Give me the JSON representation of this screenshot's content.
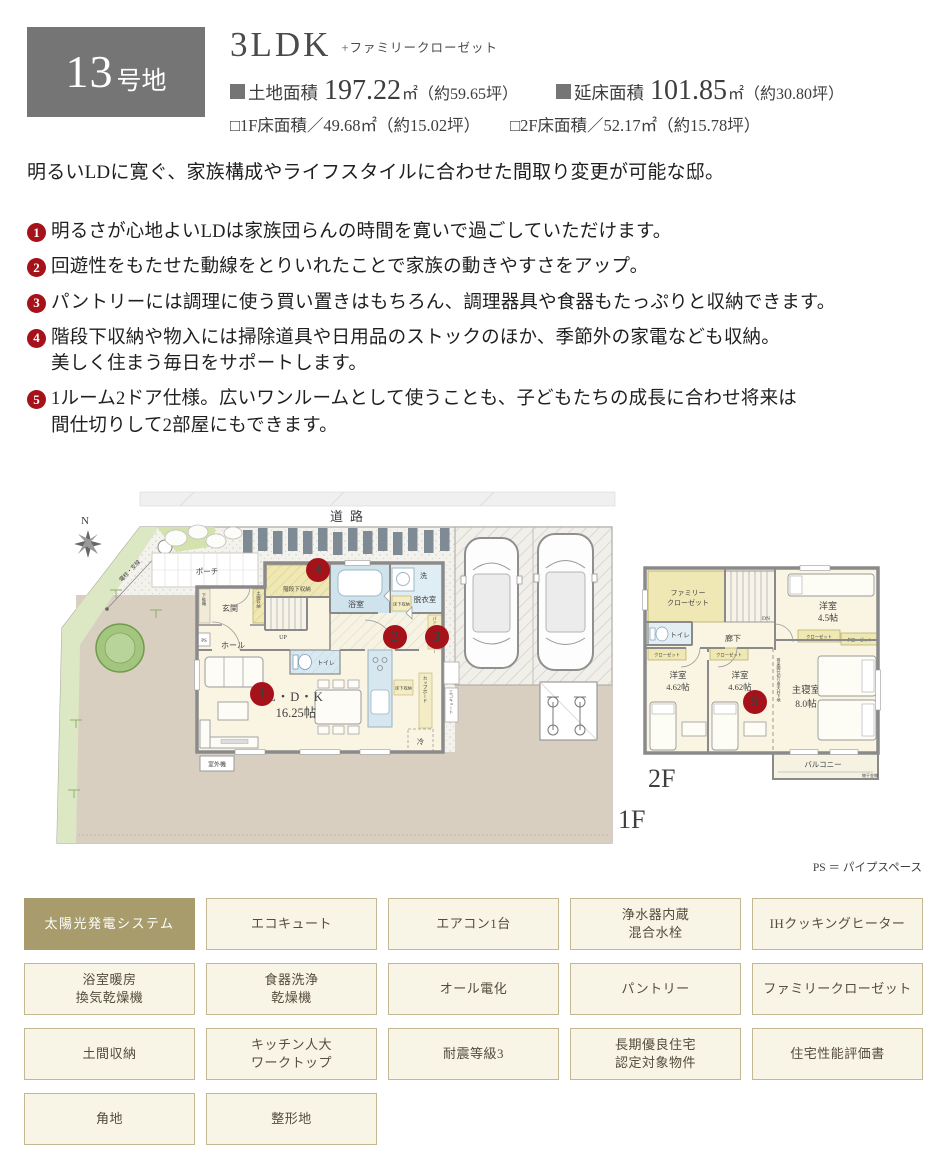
{
  "header": {
    "lot_number": "13",
    "lot_suffix": "号地",
    "plan_type": "3LDK",
    "plan_suffix": "+ファミリークローゼット",
    "areas": [
      {
        "label": "土地面積",
        "value": "197.22",
        "unit": "㎡",
        "tsubo": "（約59.65坪）"
      },
      {
        "label": "延床面積",
        "value": "101.85",
        "unit": "㎡",
        "tsubo": "（約30.80坪）"
      }
    ],
    "sub_areas": [
      "□1F床面積／49.68㎡（約15.02坪）",
      "□2F床面積／52.17㎡（約15.78坪）"
    ]
  },
  "description": {
    "intro": "明るいLDに寛ぐ、家族構成やライフスタイルに合わせた間取り変更が可能な邸。",
    "points": [
      {
        "num": "1",
        "text": "明るさが心地よいLDは家族団らんの時間を寛いで過ごしていただけます。"
      },
      {
        "num": "2",
        "text": "回遊性をもたせた動線をとりいれたことで家族の動きやすさをアップ。"
      },
      {
        "num": "3",
        "text": "パントリーには調理に使う買い置きはもちろん、調理器具や食器もたっぷりと収納できます。"
      },
      {
        "num": "4",
        "text": "階段下収納や物入には掃除道具や日用品のストックのほか、季節外の家電なども収納。\n美しく住まう毎日をサポートします。"
      },
      {
        "num": "5",
        "text": "1ルーム2ドア仕様。広いワンルームとして使うことも、子どもたちの成長に合わせ将来は\n間仕切りして2部屋にもできます。"
      }
    ]
  },
  "floorplan": {
    "road_label": "道路",
    "compass_label": "N",
    "pole_label": "電柱・支線",
    "floor1_label": "1F",
    "floor2_label": "2F",
    "ps_note": "PS ＝ パイプスペース",
    "badges": [
      "1",
      "2",
      "3",
      "4",
      "5"
    ],
    "rooms_1f": {
      "porch": "ポーチ",
      "entrance": "玄関",
      "shoe_box": "下駄箱",
      "doma_storage": "土間収納",
      "hall": "ホール",
      "ps": "PS",
      "up": "UP",
      "stair_storage": "階段下収納",
      "bath": "浴室",
      "wash": "洗",
      "dressing": "脱衣室",
      "floor_storage": "床下収納",
      "toilet": "トイレ",
      "pantry": "パントリー",
      "cupboard": "カップボード",
      "fridge": "冷",
      "ldk_name": "L・D・K",
      "ldk_size": "16.25帖",
      "outdoor_unit": "室外機",
      "ecocute": "エコキュート"
    },
    "rooms_2f": {
      "family_closet_l1": "ファミリー",
      "family_closet_l2": "クローゼット",
      "dn": "DN",
      "toilet": "トイレ",
      "hallway": "廊下",
      "closet": "クローゼット",
      "room45_label": "洋室",
      "room45_size": "4.5帖",
      "room462_label": "洋室",
      "room462_size": "4.62帖",
      "master_label": "主寝室",
      "master_size": "8.0帖",
      "balcony": "バルコニー",
      "balcony_note": "物干金物",
      "partition_note": "将来間仕切り用天井下地"
    }
  },
  "features": {
    "items": [
      {
        "label": "太陽光発電システム",
        "highlight": true
      },
      {
        "label": "エコキュート",
        "highlight": false
      },
      {
        "label": "エアコン1台",
        "highlight": false
      },
      {
        "label": "浄水器内蔵\n混合水栓",
        "highlight": false
      },
      {
        "label": "IHクッキングヒーター",
        "highlight": false
      },
      {
        "label": "浴室暖房\n換気乾燥機",
        "highlight": false
      },
      {
        "label": "食器洗浄\n乾燥機",
        "highlight": false
      },
      {
        "label": "オール電化",
        "highlight": false
      },
      {
        "label": "パントリー",
        "highlight": false
      },
      {
        "label": "ファミリークローゼット",
        "highlight": false
      },
      {
        "label": "土間収納",
        "highlight": false
      },
      {
        "label": "キッチン人大\nワークトップ",
        "highlight": false
      },
      {
        "label": "耐震等級3",
        "highlight": false
      },
      {
        "label": "長期優良住宅\n認定対象物件",
        "highlight": false
      },
      {
        "label": "住宅性能評価書",
        "highlight": false
      },
      {
        "label": "角地",
        "highlight": false
      },
      {
        "label": "整形地",
        "highlight": false
      }
    ]
  },
  "colors": {
    "badge_gray": "#757575",
    "accent_red": "#a5121a",
    "tag_cream": "#f8f4e6",
    "tag_border": "#c3b794",
    "tag_highlight": "#a89c6d",
    "room_cream": "#faf5e3",
    "bath_blue": "#cfe3ed",
    "closet_yellow": "#f0e8b4",
    "wall_gray": "#8a8a8a",
    "ground_beige": "#d9cfc1",
    "green": "#dce8c4"
  }
}
